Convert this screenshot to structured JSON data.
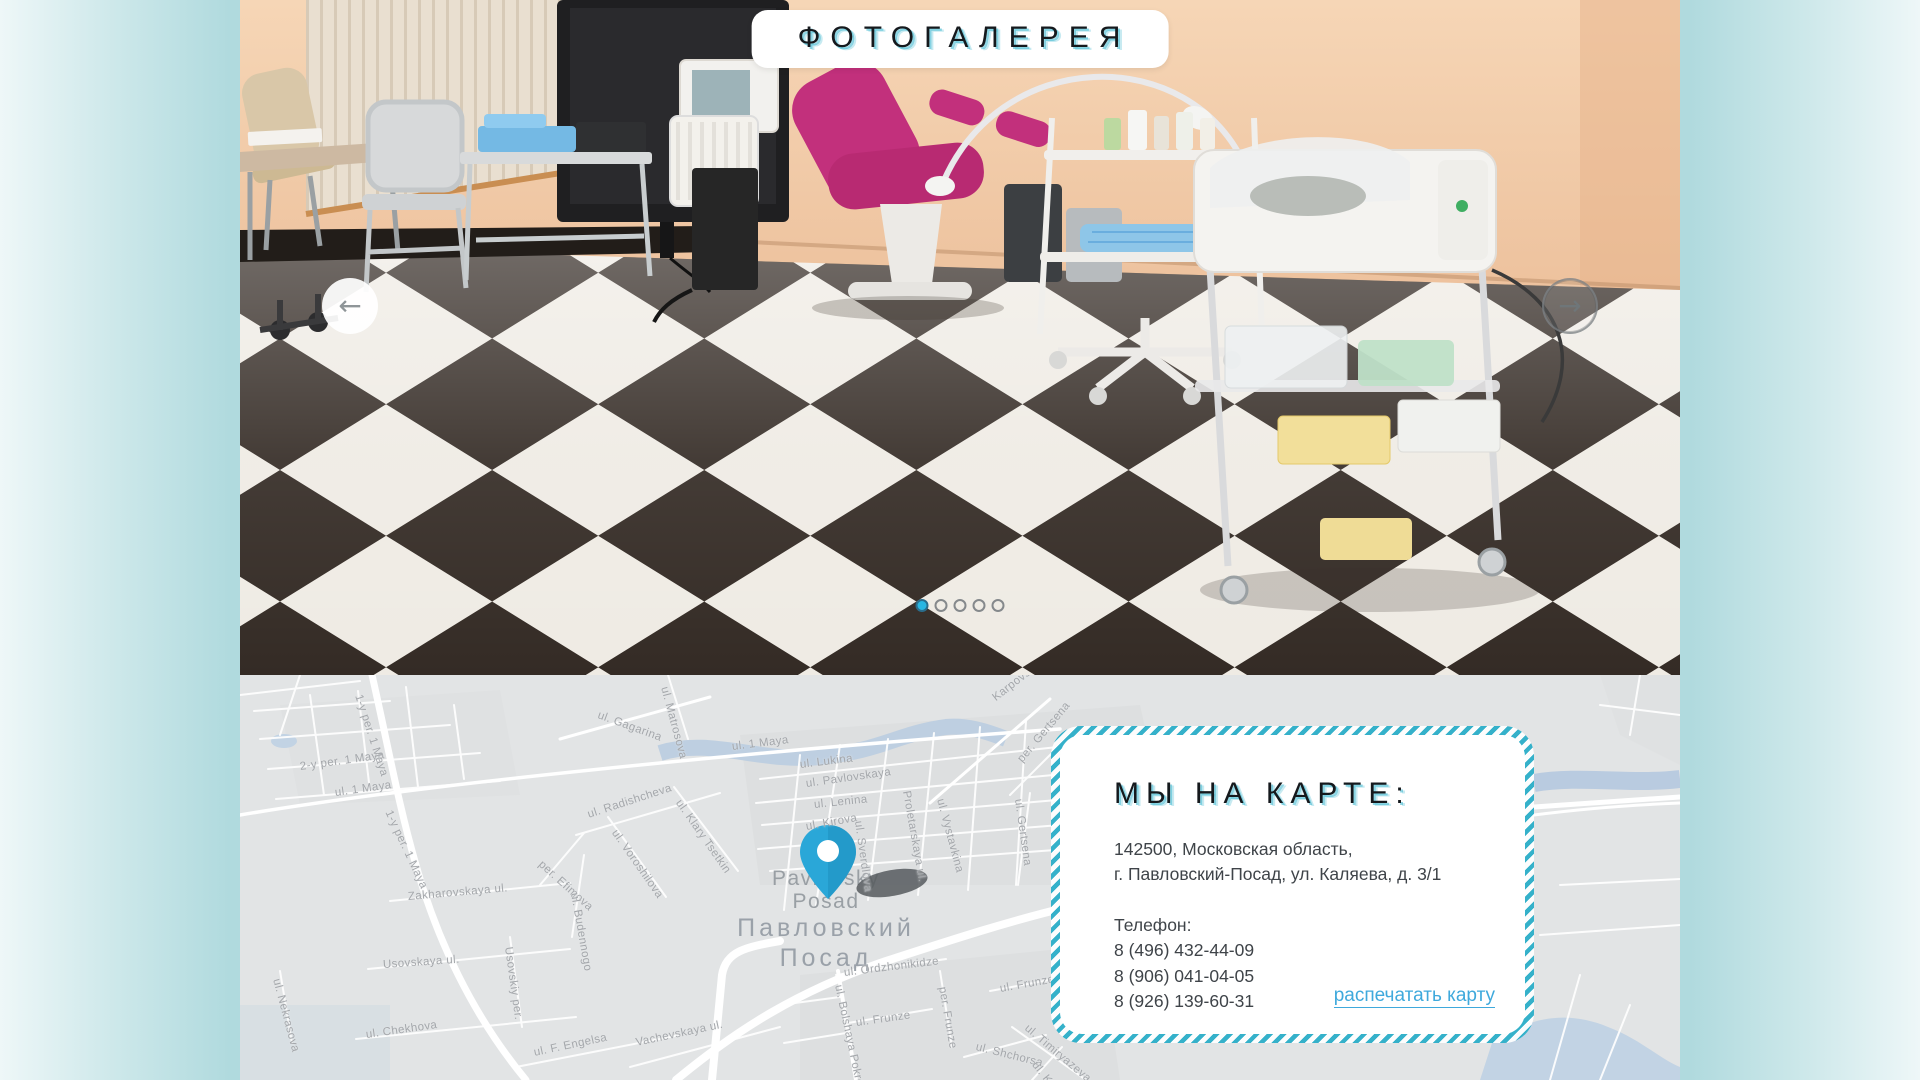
{
  "theme": {
    "accent_teal": "#35b1ca",
    "link_blue": "#3fa9dc",
    "active_dot": "#29b6e2",
    "pin_blue": "#2aa7d8",
    "map_label_gray": "#a4a7ab"
  },
  "gallery": {
    "title": "ФОТОГАЛЕРЕЯ",
    "prev_icon": "←",
    "next_icon": "→",
    "dots": [
      {
        "active": true
      },
      {
        "active": false
      },
      {
        "active": false
      },
      {
        "active": false
      },
      {
        "active": false
      }
    ]
  },
  "map": {
    "city": {
      "en_line1": "Pavlovsky",
      "en_line2": "Posad",
      "ru_line1": "Павловский",
      "ru_line2": "Посад"
    },
    "street_labels": [
      {
        "name": "2-y per. 1 Maya",
        "x": 60,
        "y": 86,
        "r": -8
      },
      {
        "name": "ul. 1 Maya",
        "x": 95,
        "y": 112,
        "r": -8
      },
      {
        "name": "1-y per. 1 Maya",
        "x": 118,
        "y": 14,
        "r": 72
      },
      {
        "name": "1-y per. 1 Maya",
        "x": 148,
        "y": 130,
        "r": 65
      },
      {
        "name": "ul. 1 Maya",
        "x": 492,
        "y": 66,
        "r": -7
      },
      {
        "name": "ul. Gagarina",
        "x": 358,
        "y": 34,
        "r": 20
      },
      {
        "name": "ul. Matrosova",
        "x": 424,
        "y": 6,
        "r": 75
      },
      {
        "name": "ul. Radishcheva",
        "x": 348,
        "y": 134,
        "r": -18
      },
      {
        "name": "ul. Voroshilova",
        "x": 374,
        "y": 150,
        "r": 55
      },
      {
        "name": "ul. Klary Tsetkin",
        "x": 438,
        "y": 120,
        "r": 55
      },
      {
        "name": "per. Efimova",
        "x": 300,
        "y": 182,
        "r": 42
      },
      {
        "name": "ul. Budennogo",
        "x": 334,
        "y": 212,
        "r": 80
      },
      {
        "name": "Zakharovskaya ul.",
        "x": 168,
        "y": 216,
        "r": -5
      },
      {
        "name": "ul. Nekrasova",
        "x": 36,
        "y": 298,
        "r": 75
      },
      {
        "name": "Usovskaya ul.",
        "x": 143,
        "y": 284,
        "r": -4
      },
      {
        "name": "Usovskiy per.",
        "x": 268,
        "y": 266,
        "r": 82
      },
      {
        "name": "ul. Chekhova",
        "x": 126,
        "y": 354,
        "r": -8
      },
      {
        "name": "ul. F. Engelsa",
        "x": 294,
        "y": 372,
        "r": -12
      },
      {
        "name": "Vachevskaya ul.",
        "x": 396,
        "y": 362,
        "r": -12
      },
      {
        "name": "ul. Lukina",
        "x": 560,
        "y": 84,
        "r": -7
      },
      {
        "name": "ul. Pavlovskaya",
        "x": 566,
        "y": 103,
        "r": -8
      },
      {
        "name": "ul. Lenina",
        "x": 574,
        "y": 124,
        "r": -6
      },
      {
        "name": "ul. Kirova",
        "x": 566,
        "y": 146,
        "r": -10
      },
      {
        "name": "ul. Sverdlova",
        "x": 618,
        "y": 140,
        "r": 82
      },
      {
        "name": "Proletarskaya ul.",
        "x": 666,
        "y": 110,
        "r": 80
      },
      {
        "name": "ul. Vystavkina",
        "x": 700,
        "y": 118,
        "r": 75
      },
      {
        "name": "Karpovskaya ul.",
        "x": 754,
        "y": 18,
        "r": -38
      },
      {
        "name": "per. Gertsena",
        "x": 780,
        "y": 80,
        "r": -50
      },
      {
        "name": "ul. Gertsena",
        "x": 778,
        "y": 118,
        "r": 82
      },
      {
        "name": "ul. Ordzhonikidze",
        "x": 604,
        "y": 292,
        "r": -7
      },
      {
        "name": "per. Frunze",
        "x": 702,
        "y": 306,
        "r": 80
      },
      {
        "name": "ul. Frunze",
        "x": 760,
        "y": 308,
        "r": -10
      },
      {
        "name": "ul. Frunze",
        "x": 616,
        "y": 342,
        "r": -8
      },
      {
        "name": "ul. Shchorsa",
        "x": 736,
        "y": 366,
        "r": 14
      },
      {
        "name": "ul. Timiryazeva",
        "x": 786,
        "y": 346,
        "r": 40
      },
      {
        "name": "ul. Kuzmina",
        "x": 794,
        "y": 382,
        "r": 52
      },
      {
        "name": "ul. Bolshaya Pokrovskaya",
        "x": 598,
        "y": 304,
        "r": 78
      }
    ]
  },
  "card": {
    "title": "МЫ НА КАРТЕ:",
    "address_line1": "142500, Московская область,",
    "address_line2": "г. Павловский-Посад, ул. Каляева, д. 3/1",
    "phone_label": "Телефон:",
    "phones": [
      "8 (496) 432-44-09",
      "8 (906) 041-04-05",
      "8 (926) 139-60-31"
    ],
    "print_link": "распечатать карту"
  }
}
